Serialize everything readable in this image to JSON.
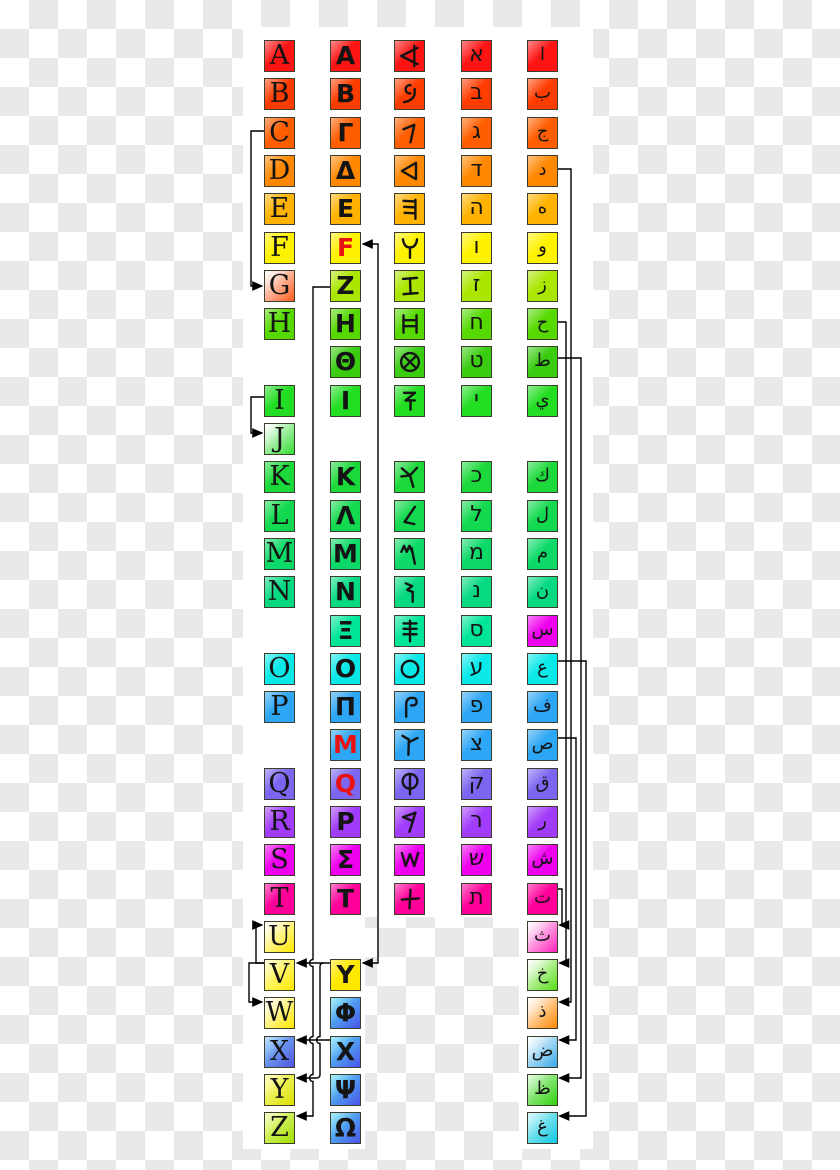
{
  "background": {
    "checker_light": "#ffffff",
    "checker_dark": "#e9e9e9",
    "panel": "#ffffff"
  },
  "palette": {
    "letter": "#141414",
    "archaic_letter_red": "#e81212",
    "line": "#000000"
  },
  "columns": [
    "latin",
    "greek",
    "phoenician",
    "hebrew",
    "arabic"
  ],
  "rows": [
    {
      "i": 0,
      "color": "#ff1414",
      "latin": "A",
      "greek": "Α",
      "phoenician": "aleph",
      "hebrew": "א",
      "arabic": "ا"
    },
    {
      "i": 1,
      "color": "#ff3c00",
      "latin": "B",
      "greek": "Β",
      "phoenician": "beth",
      "hebrew": "ב",
      "arabic": "ب"
    },
    {
      "i": 2,
      "color": "#ff5e00",
      "latin": "C",
      "greek": "Γ",
      "phoenician": "gimel",
      "hebrew": "ג",
      "arabic": "ج"
    },
    {
      "i": 3,
      "color": "#ff8800",
      "latin": "D",
      "greek": "Δ",
      "phoenician": "daleth",
      "hebrew": "ד",
      "arabic": "د"
    },
    {
      "i": 4,
      "color": "#ffb300",
      "latin": "E",
      "greek": "Ε",
      "phoenician": "he",
      "hebrew": "ה",
      "arabic": "ه"
    },
    {
      "i": 5,
      "color": "#fff200",
      "latin": "F",
      "greek": "F",
      "greekRed": true,
      "phoenician": "waw",
      "hebrew": "ו",
      "arabic": "و"
    },
    {
      "i": 6,
      "color": "#aae600",
      "latin": "G",
      "latinBg": [
        "#ffffff",
        "#ff5d1f"
      ],
      "greek": "Ζ",
      "phoenician": "zayin",
      "hebrew": "ז",
      "arabic": "ز"
    },
    {
      "i": 7,
      "color": "#55d900",
      "latin": "H",
      "greek": "Η",
      "phoenician": "heth",
      "hebrew": "ח",
      "arabic": "ح"
    },
    {
      "i": 8,
      "color": "#39cc11",
      "greek": "Θ",
      "phoenician": "teth",
      "hebrew": "ט",
      "arabic": "ط"
    },
    {
      "i": 9,
      "color": "#22dd22",
      "latin": "I",
      "greek": "Ι",
      "phoenician": "yodh",
      "hebrew": "י",
      "arabic": "ي"
    },
    {
      "i": 10,
      "latin": "J",
      "latinBg": [
        "#ffffff",
        "#33dd33"
      ]
    },
    {
      "i": 11,
      "color": "#1bd93a",
      "latin": "K",
      "greek": "Κ",
      "phoenician": "kaph",
      "hebrew": "כ",
      "arabic": "ك"
    },
    {
      "i": 12,
      "color": "#12d94f",
      "latin": "L",
      "greek": "Λ",
      "phoenician": "lamedh",
      "hebrew": "ל",
      "arabic": "ل"
    },
    {
      "i": 13,
      "color": "#0cd968",
      "latin": "M",
      "greek": "Μ",
      "phoenician": "mem",
      "hebrew": "מ",
      "arabic": "م"
    },
    {
      "i": 14,
      "color": "#06d982",
      "latin": "N",
      "greek": "Ν",
      "phoenician": "nun",
      "hebrew": "נ",
      "arabic": "ن"
    },
    {
      "i": 15,
      "color": "#00e699",
      "greek": "Ξ",
      "phoenician": "samekh",
      "hebrew": "ס",
      "arabic": "س",
      "arabicBg": "#ee00ee"
    },
    {
      "i": 16,
      "color": "#0ae8e8",
      "latin": "O",
      "greek": "Ο",
      "phoenician": "ayin",
      "hebrew": "ע",
      "arabic": "ع"
    },
    {
      "i": 17,
      "color": "#2da6f5",
      "latin": "P",
      "greek": "Π",
      "phoenician": "pe",
      "hebrew": "פ",
      "arabic": "ف"
    },
    {
      "i": 18,
      "color": "#2da6f5",
      "greek": "M",
      "greekRed": true,
      "phoenician": "tsade",
      "hebrew": "צ",
      "arabic": "ص"
    },
    {
      "i": 19,
      "color": "#7a66f0",
      "latin": "Q",
      "greek": "Q",
      "greekRed": true,
      "phoenician": "qoph",
      "hebrew": "ק",
      "arabic": "ق"
    },
    {
      "i": 20,
      "color": "#a03cfa",
      "latin": "R",
      "greek": "Ρ",
      "phoenician": "resh",
      "hebrew": "ר",
      "arabic": "ر"
    },
    {
      "i": 21,
      "color": "#ee00ee",
      "latin": "S",
      "greek": "Σ",
      "phoenician": "shin",
      "hebrew": "ש",
      "arabic": "ش"
    },
    {
      "i": 22,
      "color": "#ff0099",
      "latin": "T",
      "greek": "Τ",
      "phoenician": "taw",
      "hebrew": "ת",
      "arabic": "ت"
    },
    {
      "i": 23,
      "latin": "U",
      "latinBg": [
        "#ffffff",
        "#ffe800"
      ],
      "arabic": "ث",
      "arabicBg": [
        "#ffffff",
        "#ff22bb"
      ]
    },
    {
      "i": 24,
      "latin": "V",
      "latinBg": [
        "#ffffbb",
        "#ffe800"
      ],
      "greek": "Y",
      "greekBg": "#ffe800",
      "arabic": "خ",
      "arabicBg": [
        "#ffffff",
        "#55dd11"
      ]
    },
    {
      "i": 25,
      "latin": "W",
      "latinBg": [
        "#ffffff",
        "#ffe800"
      ],
      "greek": "Φ",
      "greekBg": [
        "#55ddf8",
        "#4a55e8"
      ],
      "arabic": "ذ",
      "arabicBg": [
        "#ffffff",
        "#ff8800"
      ]
    },
    {
      "i": 26,
      "latin": "X",
      "latinBg": [
        "#7fc8fa",
        "#5055e0"
      ],
      "greek": "Χ",
      "greekBg": [
        "#55ddf8",
        "#4a55e8"
      ],
      "arabic": "ض",
      "arabicBg": [
        "#ffffff",
        "#39a8e8"
      ]
    },
    {
      "i": 27,
      "latin": "Y",
      "latinBg": [
        "#ffff99",
        "#d8e000"
      ],
      "greek": "Ψ",
      "greekBg": [
        "#55ddf8",
        "#4a55e8"
      ],
      "arabic": "ظ",
      "arabicBg": [
        "#c8f8c0",
        "#30d010"
      ]
    },
    {
      "i": 28,
      "latin": "Z",
      "latinBg": [
        "#f0ff99",
        "#a0dd00"
      ],
      "greek": "Ω",
      "greekBg": [
        "#55ddf8",
        "#4a55e8"
      ],
      "arabic": "غ",
      "arabicBg": [
        "#bbf4f8",
        "#10c8e0"
      ]
    }
  ],
  "links": [
    {
      "name": "latin-c-to-g",
      "from": "latin-C",
      "to": "latin-G",
      "arrows": "end",
      "d": "M264 131 H251 V286 H262"
    },
    {
      "name": "latin-i-to-j",
      "from": "latin-I",
      "to": "latin-J",
      "arrows": "end",
      "d": "M264 397 H251 V433 H262"
    },
    {
      "name": "latin-v-to-u",
      "from": "latin-V",
      "to": "latin-U",
      "arrows": "end",
      "d": "M264 963 H256 V925 H262"
    },
    {
      "name": "latin-v-to-w",
      "from": "latin-V",
      "to": "latin-W",
      "arrows": "end",
      "d": "M264 963 H249 V1002 H262"
    },
    {
      "name": "waw-digamma-upsilon",
      "from": "greek-digamma",
      "to": "greek-upsilon",
      "arrows": "both",
      "d": "M363 244 H378 V963 H363"
    },
    {
      "name": "greek-zeta-to-latin-z",
      "from": "greek-Z",
      "to": "latin-Z",
      "arrows": "end",
      "d": "M330 287 H313 V959.5 A3.5 3.5 0 0 0 313 966.5 V1036.5 A3.5 3.5 0 0 0 313 1043.5 V1074.5 A3.5 3.5 0 0 0 313 1081.5 V1116 H297"
    },
    {
      "name": "greek-upsilon-to-latin-v",
      "from": "greek-upsilon",
      "to": "latin-V",
      "arrows": "end",
      "d": "M330 963 H297"
    },
    {
      "name": "greek-upsilon-to-latin-y",
      "from": "greek-upsilon",
      "to": "latin-Y",
      "arrows": "end",
      "d": "M323.5 963 Q320 963 320 966.5 V1036.5 A3.5 3.5 0 0 0 320 1043.5 V1074.5 Q320 1078 316.5 1078 H297"
    },
    {
      "name": "greek-chi-to-latin-x",
      "from": "greek-chi",
      "to": "latin-X",
      "arrows": "end",
      "d": "M330 1040 H297"
    },
    {
      "name": "arabic-ta-to-tha",
      "from": "arabic-ta",
      "to": "arabic-tha",
      "arrows": "end",
      "d": "M558 889 H562 V925 H559.5"
    },
    {
      "name": "arabic-ha-to-kha",
      "from": "arabic-ha",
      "to": "arabic-kha",
      "arrows": "end",
      "d": "M558 322 H566 V963 H559.5"
    },
    {
      "name": "arabic-dal-to-dhal",
      "from": "arabic-dal",
      "to": "arabic-dhal",
      "arrows": "end",
      "d": "M558 169 H571 V1002 H559.5"
    },
    {
      "name": "arabic-sad-to-dad",
      "from": "arabic-sad",
      "to": "arabic-dad",
      "arrows": "end",
      "d": "M558 738 H576 V1040 H559.5"
    },
    {
      "name": "arabic-taa-to-zaa",
      "from": "arabic-taa",
      "to": "arabic-zaa",
      "arrows": "end",
      "d": "M558 358 H581 V1078 H559.5"
    },
    {
      "name": "arabic-ayn-to-ghayn",
      "from": "arabic-ayn",
      "to": "arabic-ghayn",
      "arrows": "end",
      "d": "M558 661 H586 V1116 H559.5"
    }
  ]
}
